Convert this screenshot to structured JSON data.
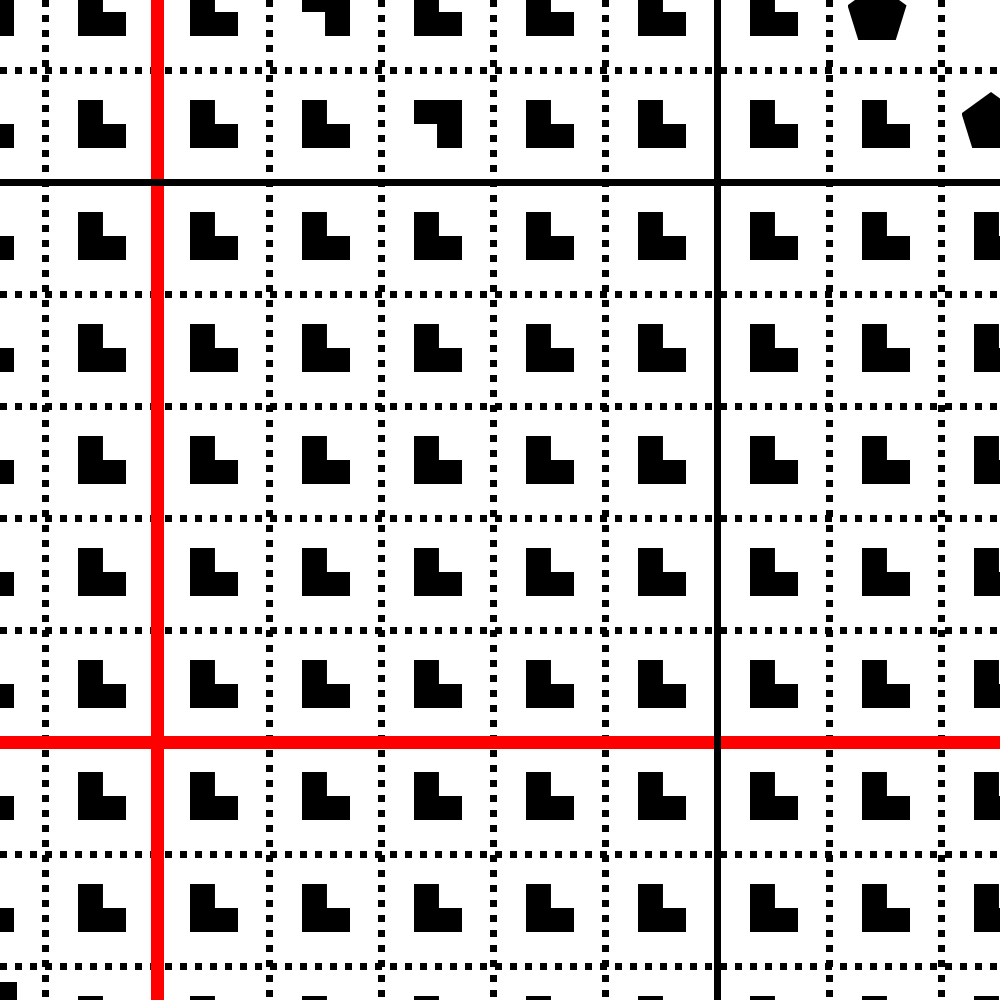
{
  "board": {
    "width": 1000,
    "height": 1000,
    "background_color": "#ffffff"
  },
  "grid": {
    "columns": 10,
    "rows": 10,
    "cell_size": 112,
    "first_col_left": -67,
    "first_row_top": -42,
    "vertical_lines_x": [
      45,
      157,
      269,
      381,
      493,
      605,
      717,
      829,
      941
    ],
    "horizontal_lines_y": [
      70,
      182,
      294,
      406,
      518,
      630,
      742,
      854,
      966
    ],
    "dotted_line": {
      "color": "#000000",
      "thickness": 7,
      "dot_length": 7,
      "gap_length": 8
    }
  },
  "special_lines": [
    {
      "id": "red-vertical-line",
      "orientation": "vertical",
      "position": 157,
      "color": "#ff0000",
      "thickness": 13
    },
    {
      "id": "red-horizontal-line",
      "orientation": "horizontal",
      "position": 742,
      "color": "#ff0000",
      "thickness": 13
    },
    {
      "id": "black-horizontal-line",
      "orientation": "horizontal",
      "position": 182,
      "color": "#000000",
      "thickness": 7
    },
    {
      "id": "black-vertical-line",
      "orientation": "vertical",
      "position": 717,
      "color": "#000000",
      "thickness": 7
    }
  ],
  "glyphs": {
    "color": "#000000",
    "default_type": "L",
    "size": 48,
    "offset_in_cell": {
      "x": 33,
      "y": 30
    },
    "pentagon_size": {
      "width": 59,
      "height": 56
    },
    "anomalies": [
      {
        "col": 0,
        "row": 0,
        "type": "L-rotated-180"
      },
      {
        "col": 3,
        "row": 0,
        "type": "L-rotated-180"
      },
      {
        "col": 4,
        "row": 1,
        "type": "L-rotated-180"
      },
      {
        "col": 8,
        "row": 0,
        "type": "pentagon",
        "cx": 877,
        "cy": 15
      },
      {
        "col": 9,
        "row": 1,
        "type": "pentagon",
        "cx": 991,
        "cy": 123
      },
      {
        "col": 9,
        "row": 0,
        "type": "empty"
      },
      {
        "col": 0,
        "row": 9,
        "type": "square",
        "cx": -7,
        "cy": 1006
      }
    ]
  }
}
